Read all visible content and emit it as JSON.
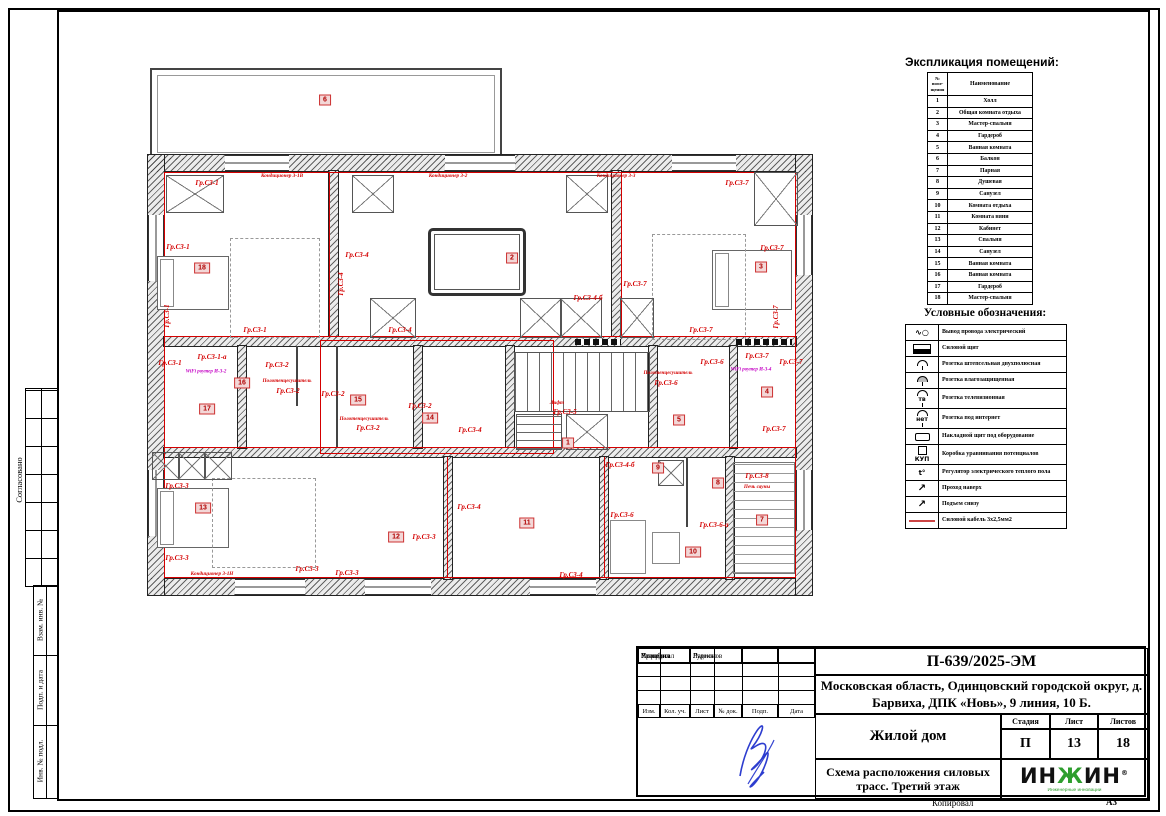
{
  "left_margin": {
    "agreed": "Согласовано",
    "vzam": "Взам. инв. №",
    "podp": "Подп. и дата",
    "inv": "Инв. № подл."
  },
  "explication": {
    "title": "Экспликация помещений:",
    "col_num": "№\nпоме-\nщения",
    "col_name": "Наименование",
    "rows": [
      {
        "num": "1",
        "name": "Холл"
      },
      {
        "num": "2",
        "name": "Общая комната отдыха"
      },
      {
        "num": "3",
        "name": "Мастер-спальня"
      },
      {
        "num": "4",
        "name": "Гардероб"
      },
      {
        "num": "5",
        "name": "Ванная комната"
      },
      {
        "num": "6",
        "name": "Балкон"
      },
      {
        "num": "7",
        "name": "Парная"
      },
      {
        "num": "8",
        "name": "Душевая"
      },
      {
        "num": "9",
        "name": "Санузел"
      },
      {
        "num": "10",
        "name": "Комната отдыха"
      },
      {
        "num": "11",
        "name": "Комната няни"
      },
      {
        "num": "12",
        "name": "Кабинет"
      },
      {
        "num": "13",
        "name": "Спальня"
      },
      {
        "num": "14",
        "name": "Санузел"
      },
      {
        "num": "15",
        "name": "Ванная комната"
      },
      {
        "num": "16",
        "name": "Ванная комната"
      },
      {
        "num": "17",
        "name": "Гардероб"
      },
      {
        "num": "18",
        "name": "Мастер-спальня"
      }
    ]
  },
  "legend": {
    "title": "Условные обозначения:",
    "items": [
      {
        "glyph": "∿○",
        "cls": "g-wire",
        "label": "Вывод провода электрический"
      },
      {
        "glyph": "",
        "cls": "g-board",
        "label": "Силовой щит"
      },
      {
        "glyph": "",
        "cls": "g-socket",
        "label": "Розетка штепсельная двухполюсная"
      },
      {
        "glyph": "",
        "cls": "g-socket g-moist",
        "label": "Розетка влагозащищенная"
      },
      {
        "glyph": "тв",
        "cls": "g-socket",
        "label": "Розетка телевизионная"
      },
      {
        "glyph": "нет",
        "cls": "g-socket",
        "label": "Розетка под интернет"
      },
      {
        "glyph": "",
        "cls": "g-surf",
        "label": "Накладной щит под оборудование"
      },
      {
        "glyph": "КУП",
        "cls": "g-kup",
        "label": "Коробка уравнивания потенциалов"
      },
      {
        "glyph": "t°",
        "cls": "g-reg",
        "label": "Регулятор электрического теплого пола"
      },
      {
        "glyph": "↗",
        "cls": "g-arrow",
        "label": "Проход наверх"
      },
      {
        "glyph": "↗",
        "cls": "g-arrow",
        "label": "Подъем снизу"
      },
      {
        "glyph": "",
        "cls": "g-redline",
        "label": "Силовой кабель 3х2,5мм2"
      }
    ]
  },
  "title_block": {
    "doc_number": "П-639/2025-ЭМ",
    "address": "Московская область, Одинцовский городской округ, д. Барвиха, ДПК «Новь», 9 линия, 10 Б.",
    "object_name": "Жилой дом",
    "drawing_name": "Схема расположения силовых трасс. Третий этаж",
    "stage_label": "Стадия",
    "sheet_label": "Лист",
    "sheets_label": "Листов",
    "stage": "П",
    "sheet": "13",
    "sheets": "18",
    "cols": [
      "Изм.",
      "Кол. уч.",
      "Лист",
      "№ док.",
      "Подп.",
      "Дата"
    ],
    "roles": [
      {
        "role": "Разработал",
        "name": "Руденко"
      },
      {
        "role": "Проверил",
        "name": ""
      },
      {
        "role": "Утвердил",
        "name": "Ларионов"
      },
      {
        "role": "",
        "name": ""
      },
      {
        "role": "",
        "name": ""
      }
    ],
    "logo_left": "ИН",
    "logo_mid": "Ж",
    "logo_right": "ИН",
    "logo_reg": "®",
    "logo_sub": "Инженерные инновации"
  },
  "footer": {
    "copied_label": "Копировал",
    "format_label": "А3"
  },
  "plan": {
    "room_numbers": [
      {
        "n": "6",
        "x": 325,
        "y": 100
      },
      {
        "n": "18",
        "x": 202,
        "y": 268
      },
      {
        "n": "2",
        "x": 512,
        "y": 258
      },
      {
        "n": "3",
        "x": 761,
        "y": 267
      },
      {
        "n": "17",
        "x": 207,
        "y": 409
      },
      {
        "n": "16",
        "x": 242,
        "y": 383
      },
      {
        "n": "15",
        "x": 358,
        "y": 400
      },
      {
        "n": "14",
        "x": 430,
        "y": 418
      },
      {
        "n": "1",
        "x": 568,
        "y": 443
      },
      {
        "n": "5",
        "x": 679,
        "y": 420
      },
      {
        "n": "4",
        "x": 767,
        "y": 392
      },
      {
        "n": "9",
        "x": 658,
        "y": 468
      },
      {
        "n": "8",
        "x": 718,
        "y": 483
      },
      {
        "n": "13",
        "x": 203,
        "y": 508
      },
      {
        "n": "12",
        "x": 396,
        "y": 537
      },
      {
        "n": "11",
        "x": 527,
        "y": 523
      },
      {
        "n": "10",
        "x": 693,
        "y": 552
      },
      {
        "n": "7",
        "x": 762,
        "y": 520
      }
    ],
    "labels": [
      {
        "t": "Гр.С3-1",
        "x": 207,
        "y": 183
      },
      {
        "t": "Кондиционер 3-1В",
        "x": 282,
        "y": 176,
        "cls": "sm"
      },
      {
        "t": "Кондиционер 3-2",
        "x": 448,
        "y": 176,
        "cls": "sm"
      },
      {
        "t": "Кондиционер 3-3",
        "x": 616,
        "y": 176,
        "cls": "sm"
      },
      {
        "t": "Гр.С3-7",
        "x": 737,
        "y": 183
      },
      {
        "t": "Гр.С3-1",
        "x": 178,
        "y": 247
      },
      {
        "t": "Гр.С3-4",
        "x": 357,
        "y": 255
      },
      {
        "t": "Гр.С3-4",
        "x": 341,
        "y": 284,
        "cls": "vert"
      },
      {
        "t": "Гр.С3-7",
        "x": 772,
        "y": 248
      },
      {
        "t": "Гр.С3-7",
        "x": 635,
        "y": 284
      },
      {
        "t": "Гр.С3-4-б",
        "x": 588,
        "y": 298
      },
      {
        "t": "Гр.С3-7",
        "x": 776,
        "y": 317,
        "cls": "vert"
      },
      {
        "t": "Гр.С3-1",
        "x": 167,
        "y": 316,
        "cls": "vert"
      },
      {
        "t": "Гр.С3-1",
        "x": 255,
        "y": 330
      },
      {
        "t": "Гр.С3-4",
        "x": 400,
        "y": 330
      },
      {
        "t": "Гр.С3-7",
        "x": 701,
        "y": 330
      },
      {
        "t": "Гр.С3-1",
        "x": 170,
        "y": 363
      },
      {
        "t": "Гр.С3-1-а",
        "x": 212,
        "y": 357
      },
      {
        "t": "WiFi роутер И-3-2",
        "x": 206,
        "y": 372,
        "cls": "mag"
      },
      {
        "t": "Гр.С3-2",
        "x": 277,
        "y": 365
      },
      {
        "t": "Полотенцесушитель",
        "x": 287,
        "y": 381,
        "cls": "sm"
      },
      {
        "t": "Гр.С3-2",
        "x": 288,
        "y": 391
      },
      {
        "t": "Гр.С3-2",
        "x": 333,
        "y": 394
      },
      {
        "t": "Полотенцесушитель",
        "x": 364,
        "y": 419,
        "cls": "sm"
      },
      {
        "t": "Гр.С3-2",
        "x": 368,
        "y": 428
      },
      {
        "t": "Гр.С3-2",
        "x": 420,
        "y": 406
      },
      {
        "t": "Гр.С3-4",
        "x": 470,
        "y": 430
      },
      {
        "t": "Лифт",
        "x": 557,
        "y": 403,
        "cls": "sm"
      },
      {
        "t": "Гр.С3-5",
        "x": 565,
        "y": 412
      },
      {
        "t": "Полотенцесушитель",
        "x": 668,
        "y": 373,
        "cls": "sm"
      },
      {
        "t": "Гр.С3-6",
        "x": 666,
        "y": 383
      },
      {
        "t": "Гр.С3-6",
        "x": 712,
        "y": 362
      },
      {
        "t": "Гр.С3-7",
        "x": 757,
        "y": 356
      },
      {
        "t": "WiFi роутер И-3-4",
        "x": 751,
        "y": 370,
        "cls": "mag"
      },
      {
        "t": "Гр.С3-7",
        "x": 791,
        "y": 362
      },
      {
        "t": "Гр.С3-7",
        "x": 774,
        "y": 429
      },
      {
        "t": "Гр.С3-4-б",
        "x": 620,
        "y": 465
      },
      {
        "t": "Гр.С3-8",
        "x": 757,
        "y": 476
      },
      {
        "t": "Печь сауны",
        "x": 757,
        "y": 487,
        "cls": "sm"
      },
      {
        "t": "Гр.С3-6",
        "x": 622,
        "y": 515
      },
      {
        "t": "Гр.С3-6-а",
        "x": 714,
        "y": 525
      },
      {
        "t": "Гр.С3-3",
        "x": 177,
        "y": 486
      },
      {
        "t": "Гр.С3-4",
        "x": 469,
        "y": 507
      },
      {
        "t": "Гр.С3-3",
        "x": 424,
        "y": 537
      },
      {
        "t": "Гр.С3-3",
        "x": 177,
        "y": 558
      },
      {
        "t": "Кондиционер 3-1Н",
        "x": 212,
        "y": 574,
        "cls": "sm"
      },
      {
        "t": "Гр.С3-3",
        "x": 307,
        "y": 569
      },
      {
        "t": "Гр.С3-3",
        "x": 347,
        "y": 573
      },
      {
        "t": "Гр.С3-4",
        "x": 571,
        "y": 575
      }
    ]
  }
}
